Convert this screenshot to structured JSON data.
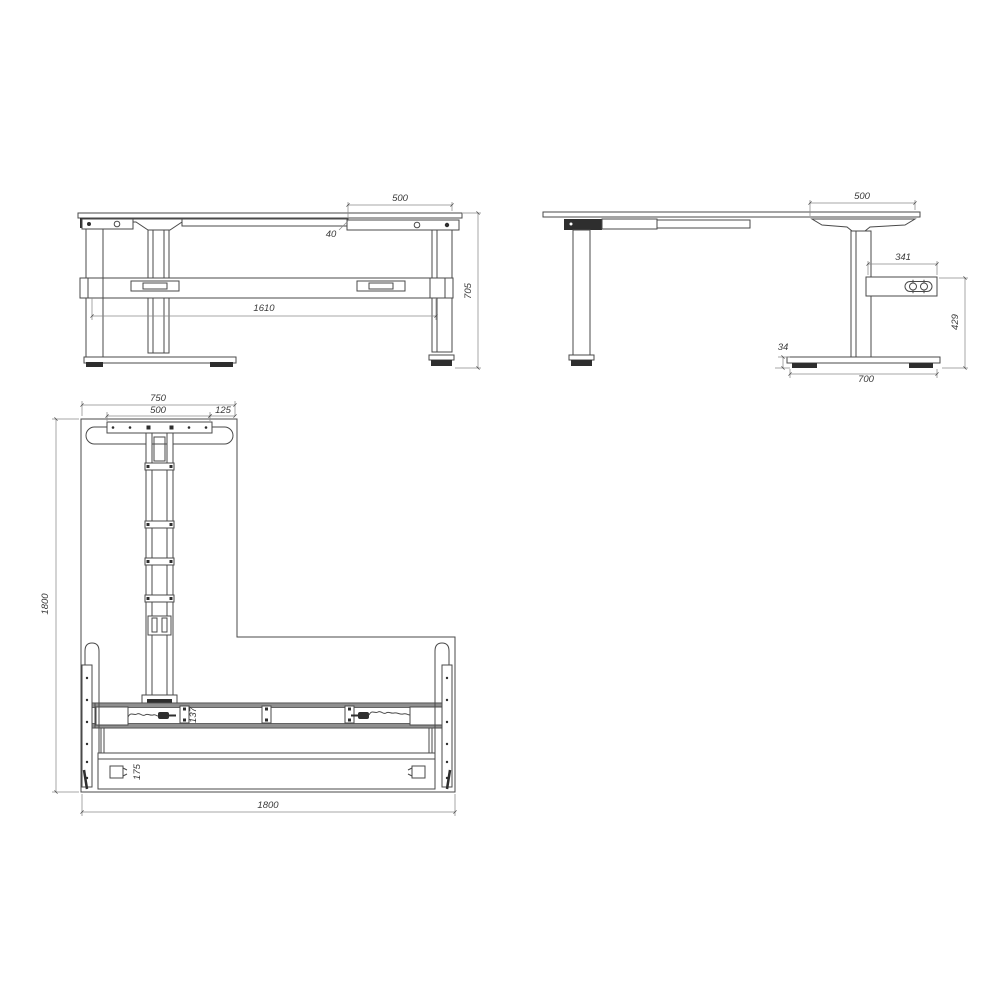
{
  "colors": {
    "background": "#ffffff",
    "line": "#4a4a4a",
    "dim_line": "#8a8a8a",
    "dark_fill": "#2e2e2e",
    "text": "#3a3a3a",
    "band_fill": "#8f8f8f"
  },
  "front_view": {
    "dim_bracket_width": "500",
    "dim_top_offset": "40",
    "dim_leg_span": "1610",
    "dim_height": "705"
  },
  "side_view": {
    "dim_overhang": "500",
    "dim_control_box_length": "341",
    "dim_control_box_height": "429",
    "dim_foot_height": "34",
    "dim_foot_length": "700"
  },
  "plan_view": {
    "dim_foot_total": "750",
    "dim_plate_width": "500",
    "dim_edge_offset": "125",
    "dim_depth": "1800",
    "dim_width": "1800",
    "dim_beam_width": "137",
    "dim_rail_width": "175"
  }
}
